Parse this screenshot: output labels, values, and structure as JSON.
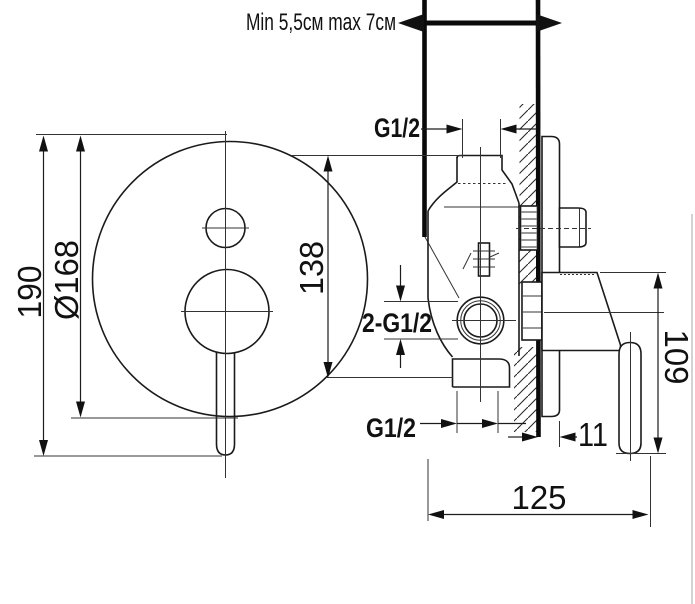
{
  "labels": {
    "depth_range": "Min 5,5см max 7см",
    "top_outlet_thread": "G1/2",
    "inlet_threads": "2-G1/2",
    "bottom_outlet_thread": "G1/2"
  },
  "dimensions": {
    "overall_height": "190",
    "plate_diameter": "Ø168",
    "outlet_spacing": "138",
    "handle_height": "109",
    "plate_to_wall": "11",
    "overall_depth": "125"
  },
  "colors": {
    "line": "#1c1c1c",
    "scan_edge": "#c8c8c8"
  }
}
